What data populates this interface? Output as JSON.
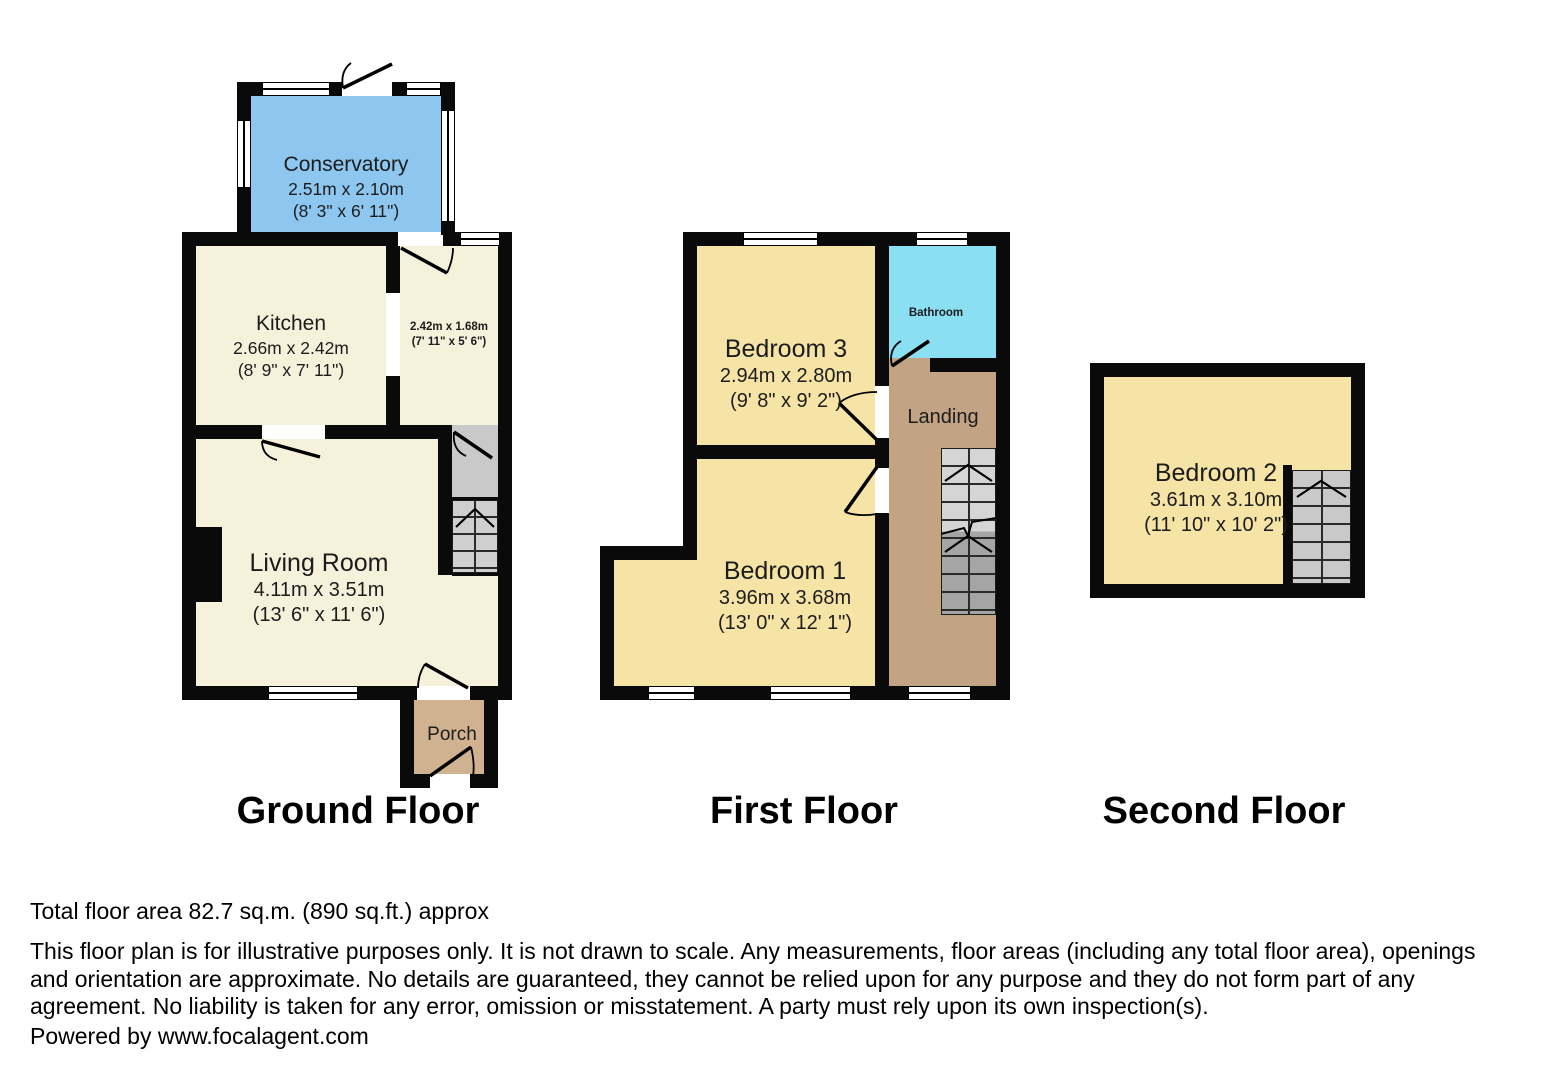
{
  "colors": {
    "wall": "#0a0a0a",
    "conservatory_fill": "#8dc7f0",
    "bathroom_fill": "#8addf2",
    "cream_room_fill": "#f6f1db",
    "bedroom_fill": "#f5e4a5",
    "landing_fill": "#c2a384",
    "porch_fill": "#d1b290",
    "stairs_light": "#d5d5d5",
    "stairs_dark": "#a5a5a5"
  },
  "floors": {
    "ground": {
      "label": "Ground Floor",
      "rooms": {
        "conservatory": {
          "name": "Conservatory",
          "dims_m": "2.51m x 2.10m",
          "dims_ft": "(8' 3\" x 6' 11\")"
        },
        "kitchen": {
          "name": "Kitchen",
          "dims_m": "2.66m x 2.42m",
          "dims_ft": "(8' 9\" x 7' 11\")"
        },
        "store": {
          "dims_m": "2.42m x 1.68m",
          "dims_ft": "(7' 11\" x 5' 6\")"
        },
        "living_room": {
          "name": "Living Room",
          "dims_m": "4.11m x 3.51m",
          "dims_ft": "(13' 6\" x 11' 6\")"
        },
        "porch": {
          "name": "Porch"
        }
      }
    },
    "first": {
      "label": "First Floor",
      "rooms": {
        "bedroom3": {
          "name": "Bedroom 3",
          "dims_m": "2.94m x 2.80m",
          "dims_ft": "(9' 8\" x 9' 2\")"
        },
        "bathroom": {
          "name": "Bathroom"
        },
        "landing": {
          "name": "Landing"
        },
        "bedroom1": {
          "name": "Bedroom 1",
          "dims_m": "3.96m x 3.68m",
          "dims_ft": "(13' 0\" x 12' 1\")"
        }
      }
    },
    "second": {
      "label": "Second Floor",
      "rooms": {
        "bedroom2": {
          "name": "Bedroom 2",
          "dims_m": "3.61m x 3.10m",
          "dims_ft": "(11' 10\" x 10' 2\")"
        }
      }
    }
  },
  "footer": {
    "total_area": "Total floor area 82.7 sq.m. (890 sq.ft.) approx",
    "disclaimer": "This floor plan is for illustrative purposes only. It is not drawn to scale. Any measurements, floor areas (including any total floor area), openings and orientation are approximate. No details are guaranteed, they cannot be relied upon for any purpose and they do not form part of any agreement. No liability is taken for any error, omission or misstatement. A party must rely upon its own inspection(s).",
    "powered_by": "Powered by www.focalagent.com"
  }
}
